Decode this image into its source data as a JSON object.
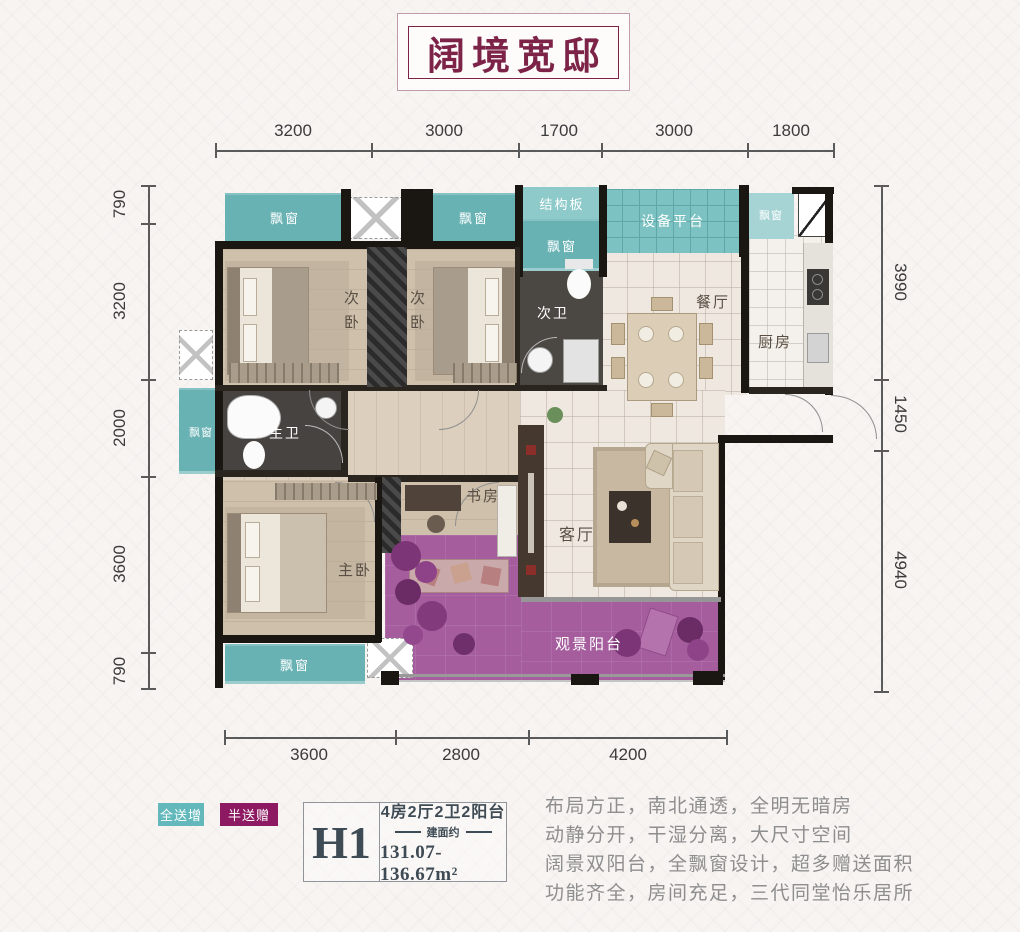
{
  "title": "阔境宽邸",
  "dimensions": {
    "top": [
      "3200",
      "3000",
      "1700",
      "3000",
      "1800"
    ],
    "left": [
      "790",
      "3200",
      "2000",
      "3600",
      "790"
    ],
    "right": [
      "3990",
      "1450",
      "4940"
    ],
    "bottom": [
      "3600",
      "2800",
      "4200"
    ]
  },
  "rooms": {
    "bay_window": "飘窗",
    "structural_slab": "结构板",
    "equipment_platform": "设备平台",
    "bedroom2": "次卧",
    "bath2": "次卫",
    "dining": "餐厅",
    "kitchen": "厨房",
    "master_bath": "主卫",
    "master_bedroom": "主卧",
    "study": "书房",
    "living": "客厅",
    "balcony": "观景阳台"
  },
  "legend": {
    "full_gift": "全送增",
    "half_gift": "半送赠"
  },
  "unit": {
    "code": "H1",
    "layout": "4房2厅2卫2阳台",
    "area_prefix": "建面约",
    "area": "131.07-136.67m²"
  },
  "description": {
    "line1": "布局方正，南北通透，全明无暗房",
    "line2": "动静分开，干湿分离，大尺寸空间",
    "line3": "阔景双阳台，全飘窗设计，超多赠送面积",
    "line4": "功能齐全，房间充足，三代同堂怡乐居所"
  },
  "colors": {
    "teal": "#68b2b4",
    "balcony_purple": "#a55d9e",
    "badge_teal": "#63b8bc",
    "badge_purple": "#8c1961",
    "title_maroon": "#7c2347"
  }
}
